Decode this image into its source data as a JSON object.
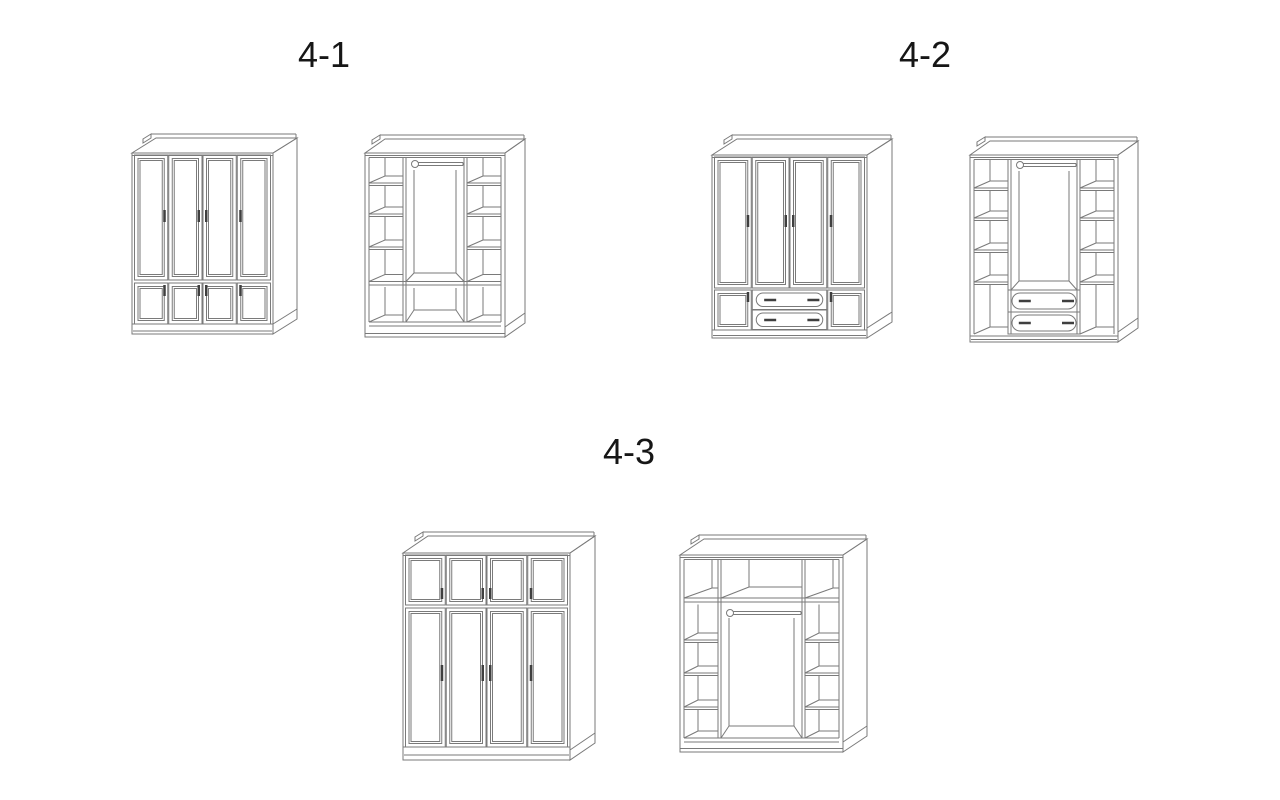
{
  "page": {
    "background": "#ffffff",
    "line_color": "#7a7a7a",
    "handle_color": "#3f3f3f",
    "label_color": "#161616"
  },
  "groups": [
    {
      "label": "4-1",
      "figures": [
        {
          "id": "w41c",
          "name": "wardrobe-4-1-exterior",
          "kind": "closed",
          "rows": [
            "tall-doors",
            "small-doors"
          ],
          "doors_per_row": 4
        },
        {
          "id": "w41o",
          "name": "wardrobe-4-1-interior",
          "kind": "open",
          "shelves_per_side": 4,
          "hanging_rod": true,
          "bottom": "shelf-row"
        }
      ]
    },
    {
      "label": "4-2",
      "figures": [
        {
          "id": "w42c",
          "name": "wardrobe-4-2-exterior",
          "kind": "closed",
          "rows": [
            "tall-doors",
            "door-drawers-door"
          ],
          "doors_per_row": 4,
          "drawers": 2
        },
        {
          "id": "w42o",
          "name": "wardrobe-4-2-interior",
          "kind": "open",
          "shelves_per_side": 5,
          "hanging_rod": true,
          "bottom": "drawers",
          "drawers": 2
        }
      ]
    },
    {
      "label": "4-3",
      "figures": [
        {
          "id": "w43c",
          "name": "wardrobe-4-3-exterior",
          "kind": "closed",
          "rows": [
            "small-doors",
            "tall-doors"
          ],
          "doors_per_row": 4
        },
        {
          "id": "w43o",
          "name": "wardrobe-4-3-interior",
          "kind": "open",
          "shelves_per_side": 4,
          "hanging_rod": true,
          "top_row": true,
          "bottom": "open"
        }
      ]
    }
  ]
}
